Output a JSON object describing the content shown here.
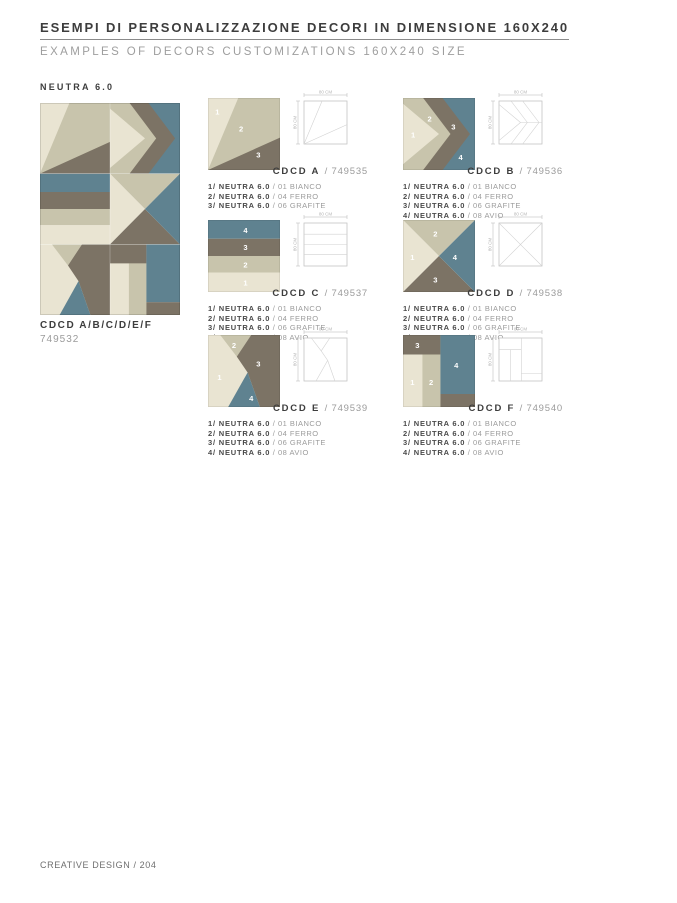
{
  "page": {
    "title": "ESEMPI DI PERSONALIZZAZIONE DECORI IN DIMENSIONE 160X240",
    "subtitle": "EXAMPLES OF DECORS CUSTOMIZATIONS 160X240 SIZE",
    "collection": "NEUTRA 6.0",
    "footer": "CREATIVE DESIGN / 204"
  },
  "composite": {
    "name": "CDCD A/B/C/D/E/F",
    "code": "749532",
    "grid": [
      [
        "A",
        "B"
      ],
      [
        "C",
        "D"
      ],
      [
        "E",
        "F"
      ]
    ]
  },
  "dimensions": {
    "width_label": "80 CM",
    "height_label": "80 CM"
  },
  "colors": {
    "bianco": "#e9e4d2",
    "ferro": "#c8c4ac",
    "grafite": "#7c7365",
    "avio": "#5f8290",
    "wire_frame": "#c4c4c4",
    "wire_lines": "#d2d2d2",
    "dim_text": "#b5b5b5"
  },
  "decors": [
    {
      "label": "CDCD A",
      "code": "/ 749535",
      "pattern": "A",
      "materials": [
        {
          "lead": "1/ NEUTRA 6.0",
          "value": "/ 01 BIANCO"
        },
        {
          "lead": "2/ NEUTRA 6.0",
          "value": "/ 04 FERRO"
        },
        {
          "lead": "3/ NEUTRA 6.0",
          "value": "/ 06 GRAFITE"
        }
      ]
    },
    {
      "label": "CDCD B",
      "code": "/ 749536",
      "pattern": "B",
      "materials": [
        {
          "lead": "1/ NEUTRA 6.0",
          "value": "/ 01 BIANCO"
        },
        {
          "lead": "2/ NEUTRA 6.0",
          "value": "/ 04 FERRO"
        },
        {
          "lead": "3/ NEUTRA 6.0",
          "value": "/ 06 GRAFITE"
        },
        {
          "lead": "4/ NEUTRA 6.0",
          "value": "/ 08 AVIO"
        }
      ]
    },
    {
      "label": "CDCD C",
      "code": "/ 749537",
      "pattern": "C",
      "materials": [
        {
          "lead": "1/ NEUTRA 6.0",
          "value": "/ 01 BIANCO"
        },
        {
          "lead": "2/ NEUTRA 6.0",
          "value": "/ 04 FERRO"
        },
        {
          "lead": "3/ NEUTRA 6.0",
          "value": "/ 06 GRAFITE"
        },
        {
          "lead": "4/ NEUTRA 6.0",
          "value": "/ 08 AVIO"
        }
      ]
    },
    {
      "label": "CDCD D",
      "code": "/ 749538",
      "pattern": "D",
      "materials": [
        {
          "lead": "1/ NEUTRA 6.0",
          "value": "/ 01 BIANCO"
        },
        {
          "lead": "2/ NEUTRA 6.0",
          "value": "/ 04 FERRO"
        },
        {
          "lead": "3/ NEUTRA 6.0",
          "value": "/ 06 GRAFITE"
        },
        {
          "lead": "4/ NEUTRA 6.0",
          "value": "/ 08 AVIO"
        }
      ]
    },
    {
      "label": "CDCD E",
      "code": "/ 749539",
      "pattern": "E",
      "materials": [
        {
          "lead": "1/ NEUTRA 6.0",
          "value": "/ 01 BIANCO"
        },
        {
          "lead": "2/ NEUTRA 6.0",
          "value": "/ 04 FERRO"
        },
        {
          "lead": "3/ NEUTRA 6.0",
          "value": "/ 06 GRAFITE"
        },
        {
          "lead": "4/ NEUTRA 6.0",
          "value": "/ 08 AVIO"
        }
      ]
    },
    {
      "label": "CDCD F",
      "code": "/ 749540",
      "pattern": "F",
      "materials": [
        {
          "lead": "1/ NEUTRA 6.0",
          "value": "/ 01 BIANCO"
        },
        {
          "lead": "2/ NEUTRA 6.0",
          "value": "/ 04 FERRO"
        },
        {
          "lead": "3/ NEUTRA 6.0",
          "value": "/ 06 GRAFITE"
        },
        {
          "lead": "4/ NEUTRA 6.0",
          "value": "/ 08 AVIO"
        }
      ]
    }
  ]
}
